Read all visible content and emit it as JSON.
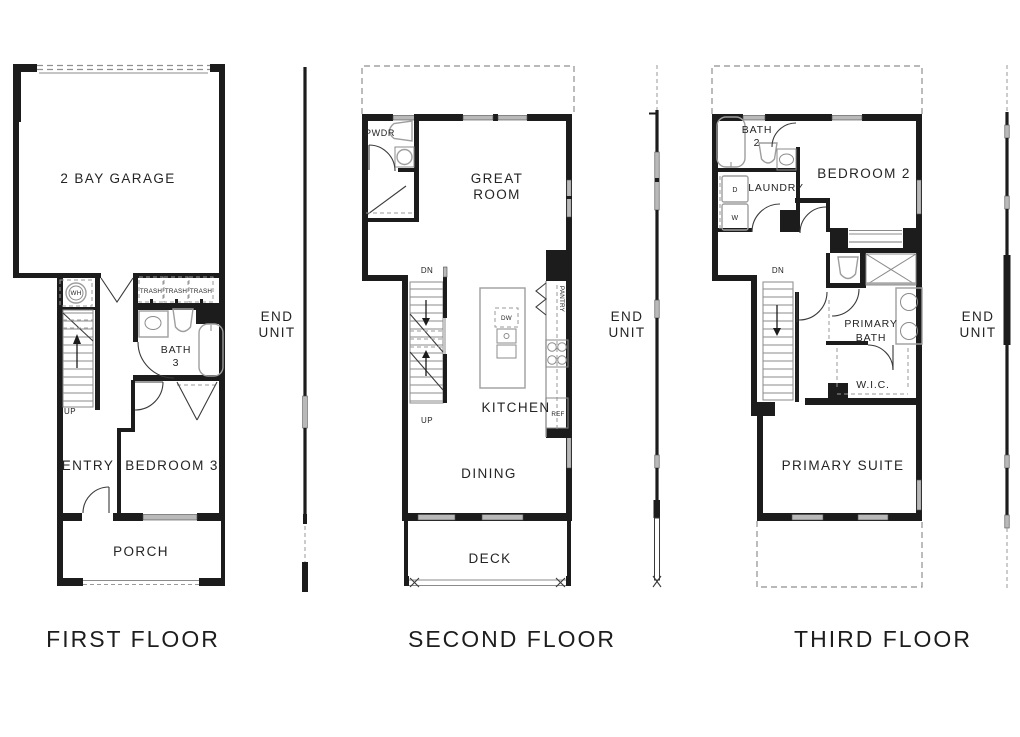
{
  "colors": {
    "wall": "#1c1c1c",
    "fixture_gray": "#9e9e9e",
    "window_gray": "#b9b9b9",
    "text": "#242424",
    "background": "#ffffff"
  },
  "end_unit": {
    "line1": "END",
    "line2": "UNIT"
  },
  "floors": {
    "first": {
      "title": "FIRST FLOOR",
      "garage": "2 BAY GARAGE",
      "wh": "WH",
      "trash": "TRASH",
      "up": "UP",
      "bath_line1": "BATH",
      "bath_line2": "3",
      "entry": "ENTRY",
      "bedroom": "BEDROOM 3",
      "porch": "PORCH"
    },
    "second": {
      "title": "SECOND FLOOR",
      "pwdr": "PWDR",
      "great_line1": "GREAT",
      "great_line2": "ROOM",
      "dn": "DN",
      "up": "UP",
      "dw": "DW",
      "pantry": "PANTRY",
      "kitchen": "KITCHEN",
      "ref": "REF",
      "dining": "DINING",
      "deck": "DECK"
    },
    "third": {
      "title": "THIRD FLOOR",
      "bath_line1": "BATH",
      "bath_line2": "2",
      "laundry": "LAUNDRY",
      "dryer": "D",
      "washer": "W",
      "bedroom": "BEDROOM 2",
      "dn": "DN",
      "pbath_line1": "PRIMARY",
      "pbath_line2": "BATH",
      "wic": "W.I.C.",
      "suite": "PRIMARY SUITE"
    }
  }
}
